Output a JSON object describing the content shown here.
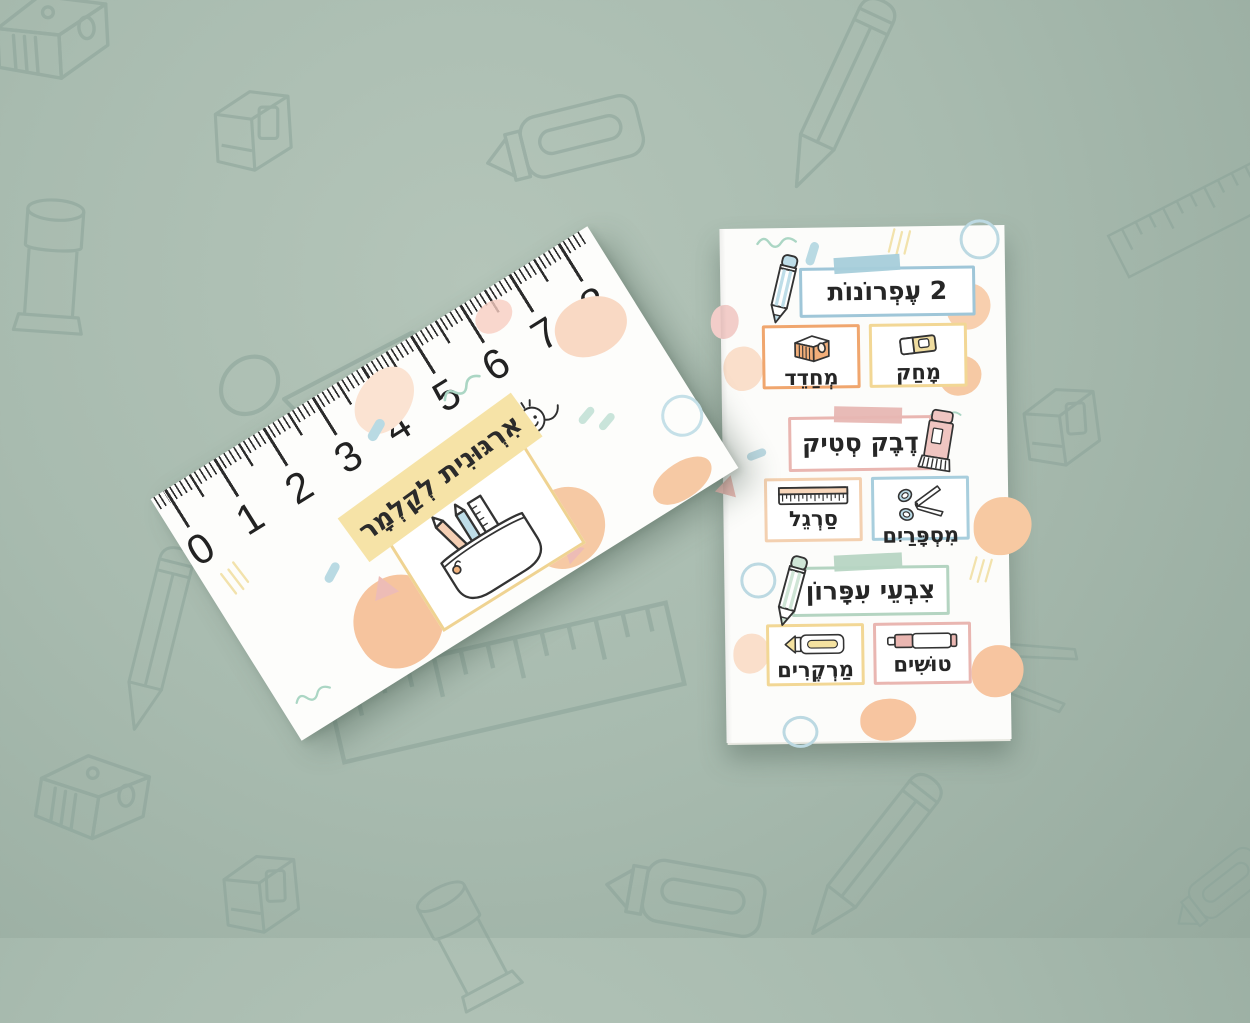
{
  "scene": {
    "background_color": "#a8bbaf",
    "doodle_color": "#8ba399",
    "background_doodles": [
      "sharpener-icon",
      "eraser-icon",
      "highlighter-icon",
      "pencil-icon",
      "ruler-icon",
      "glue-stick-icon",
      "scissors-icon",
      "pencil-icon",
      "sharpener-icon",
      "eraser-icon",
      "ruler-icon",
      "glue-stick-icon",
      "marker-icon",
      "pencil-icon",
      "scissors-icon",
      "eraser-icon",
      "marker-icon"
    ]
  },
  "left_card": {
    "title": "אִרְגּוּנִית לְקַלְמָר",
    "title_band_color": "#f6e3a7",
    "frame_border_color": "#efd392",
    "center_icon": "pencil-case-icon",
    "corner_doodle": "stick-figure-icon",
    "ruler_numbers": [
      "0",
      "1",
      "2",
      "3",
      "4",
      "5",
      "6",
      "7",
      "8"
    ]
  },
  "right_card": {
    "rows": [
      {
        "type": "banner",
        "label": "2 עֶפְרוֹנוֹת",
        "icon": "pencil-icon",
        "icon_side": "left",
        "border_color": "#9fc6d8",
        "tape_color": "#a6ceda"
      },
      {
        "type": "pair",
        "items": [
          {
            "label": "מְחַדֵד",
            "icon": "sharpener-icon",
            "border_color": "#f0a66e"
          },
          {
            "label": "מָחַק",
            "icon": "eraser-icon",
            "border_color": "#f2d795"
          }
        ]
      },
      {
        "type": "banner",
        "label": "דֶבֶק סְטִיק",
        "icon": "glue-stick-icon",
        "icon_side": "right",
        "border_color": "#e9b6b1",
        "tape_color": "#e7b7b3"
      },
      {
        "type": "pair",
        "items": [
          {
            "label": "סַרְגֵל",
            "icon": "ruler-icon",
            "border_color": "#f3d0b0"
          },
          {
            "label": "מִסְפָּרַיִם",
            "icon": "scissors-icon",
            "border_color": "#a8cedd"
          }
        ]
      },
      {
        "type": "banner",
        "label": "צִבְעֵי עִפָּרוֹן",
        "icon": "colored-pencil-icon",
        "icon_side": "left",
        "border_color": "#b4d4c1",
        "tape_color": "#b7d5c3"
      },
      {
        "type": "pair",
        "items": [
          {
            "label": "מַרְקֶרִים",
            "icon": "highlighter-icon",
            "border_color": "#f2d795"
          },
          {
            "label": "טוּשִׁים",
            "icon": "marker-icon",
            "border_color": "#e9b6b1"
          }
        ]
      }
    ]
  }
}
